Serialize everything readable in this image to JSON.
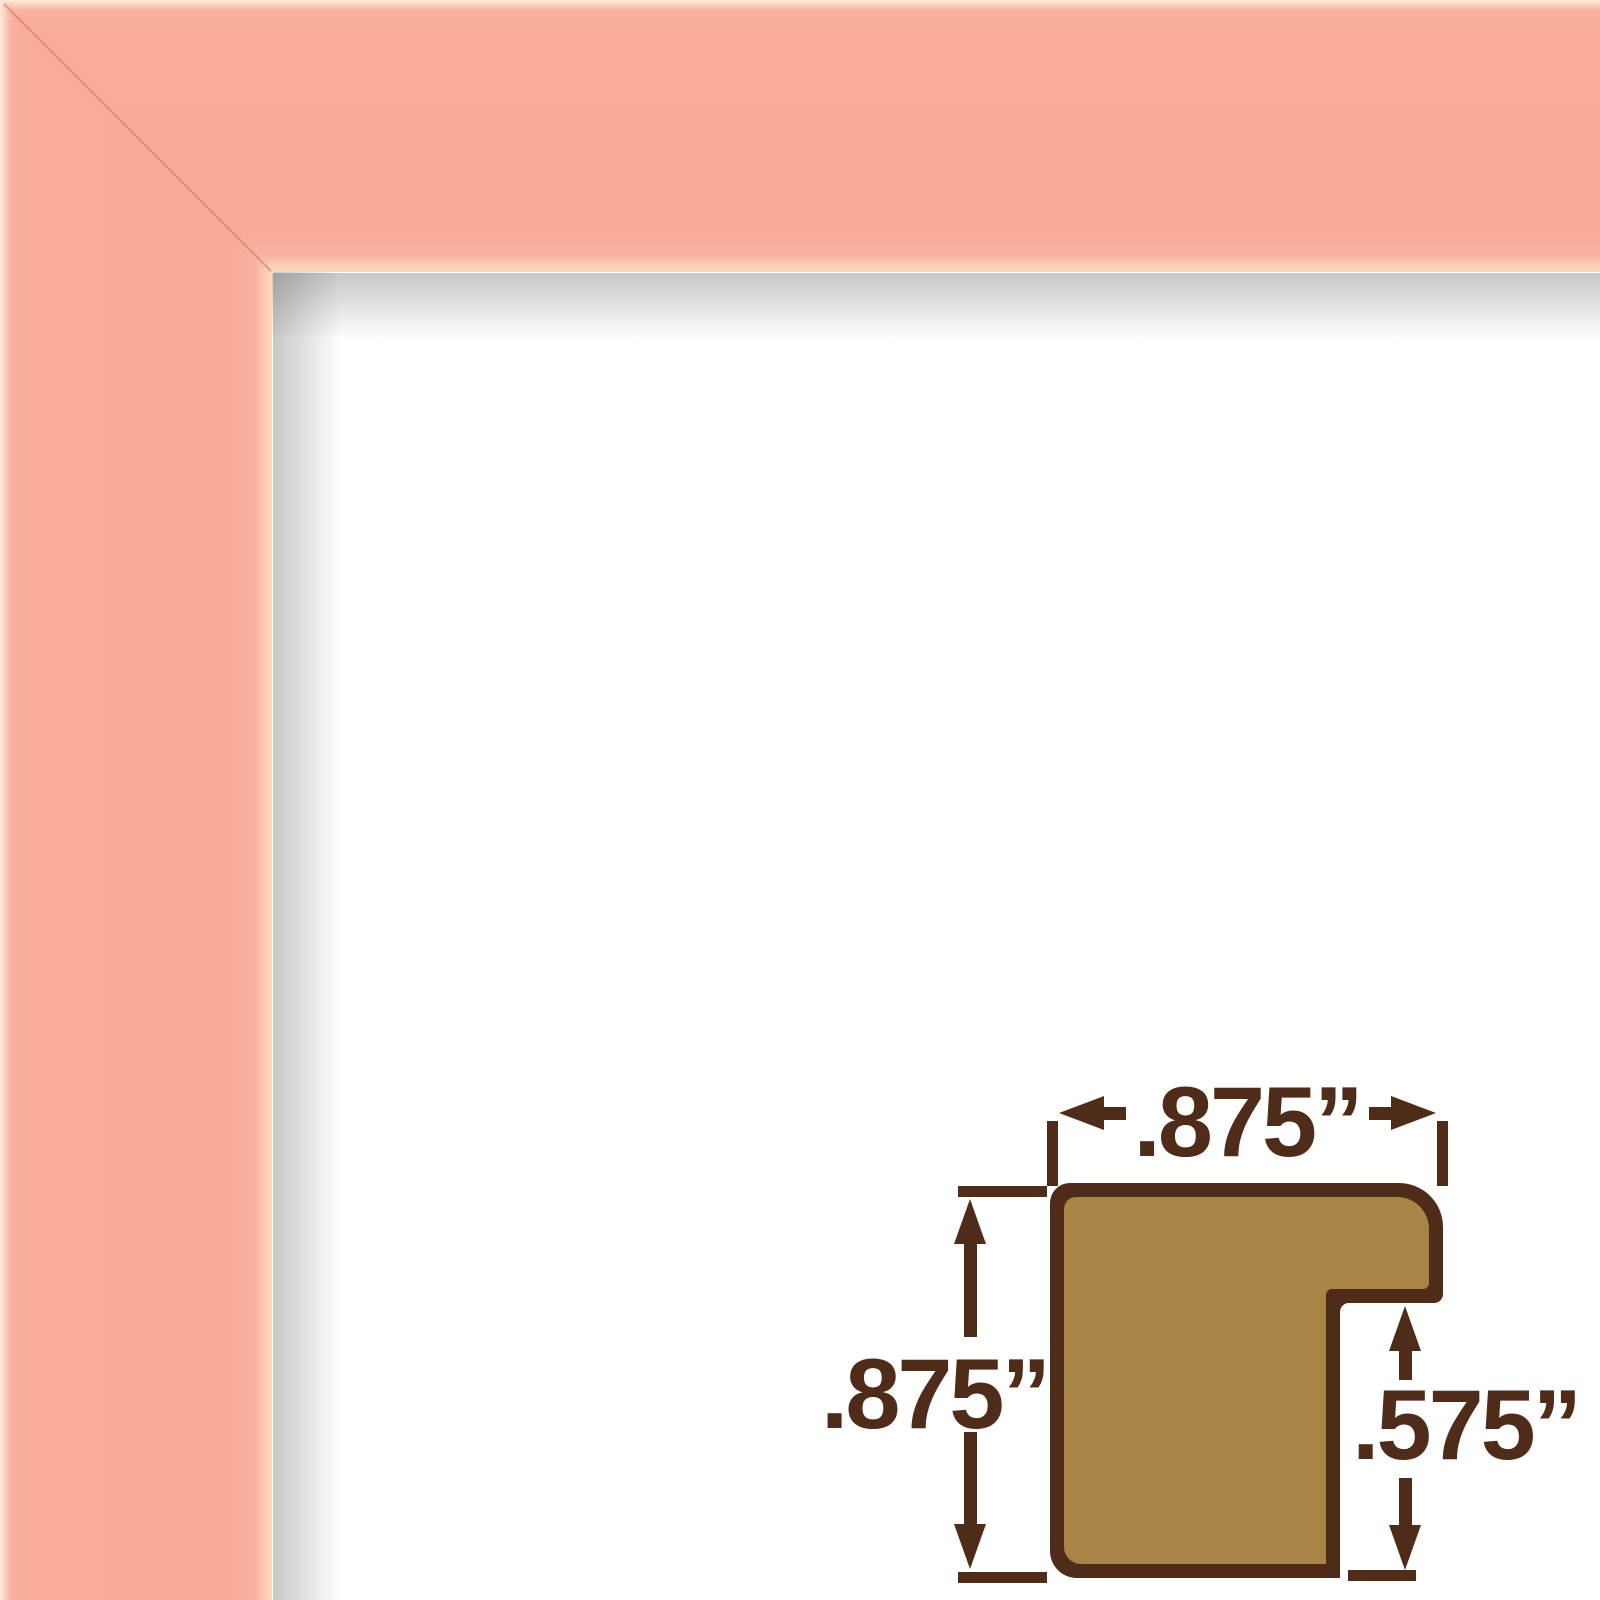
{
  "scene": {
    "title": "Pink picture frame corner sample with moulding profile dimension diagram"
  },
  "colors": {
    "background": "#ffffff",
    "frame_pink": "#f8ac99",
    "frame_edge_highlight": "#fdeada",
    "frame_inner_lip": "#fbceb1",
    "interior_shadow": "#c6c6c6",
    "diagram_gold": "#a88445",
    "diagram_brown": "#4f2b1a"
  },
  "diagram": {
    "width_label": ".875”",
    "height_label": ".875”",
    "rabbet_label": ".575”"
  }
}
